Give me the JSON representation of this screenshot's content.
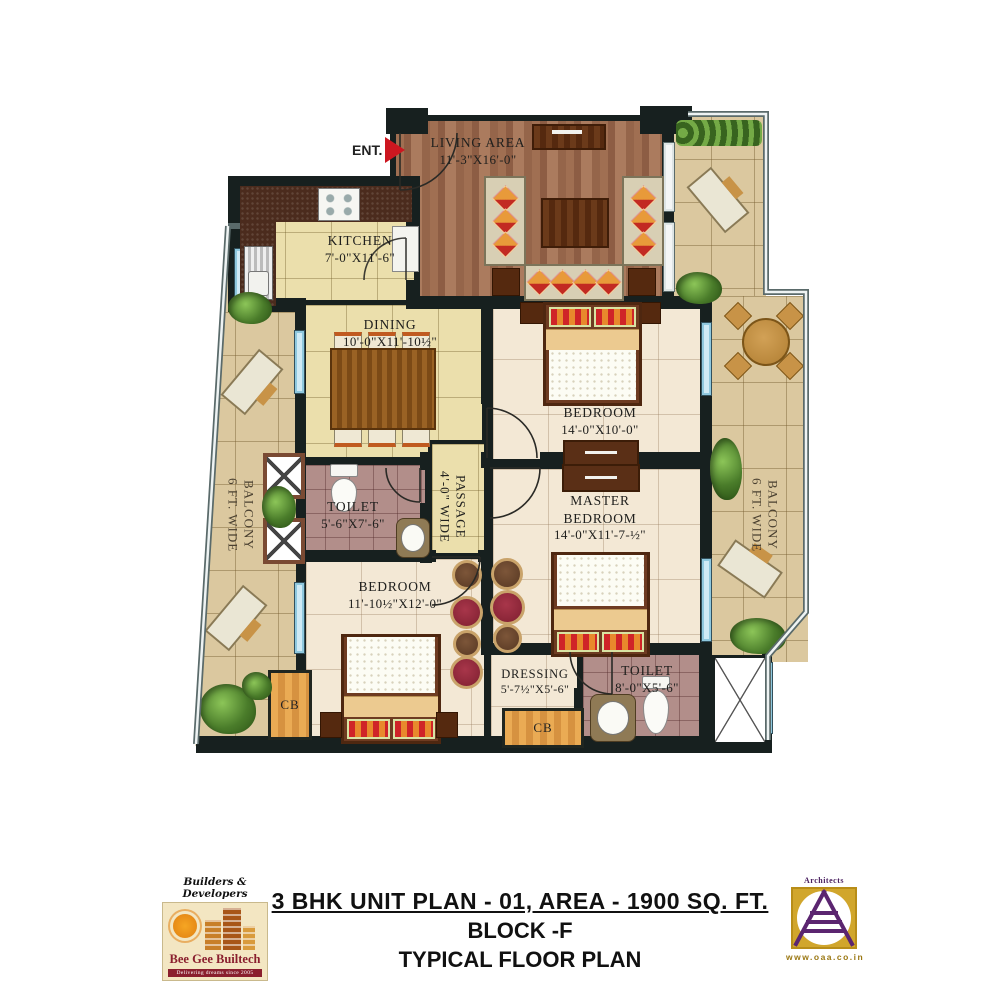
{
  "entry": {
    "label": "ENT."
  },
  "rooms": {
    "living": {
      "name": "LIVING AREA",
      "dim": "11'-3\"X16'-0\""
    },
    "kitchen": {
      "name": "KITCHEN",
      "dim": "7'-0\"X11'-6\""
    },
    "dining": {
      "name": "DINING",
      "dim": "10'-0\"X11'-10½\""
    },
    "bedroom1": {
      "name": "BEDROOM",
      "dim": "14'-0\"X10'-0\""
    },
    "master_bedroom": {
      "name": "MASTER BEDROOM",
      "dim": "14'-0\"X11'-7-½\""
    },
    "bedroom2": {
      "name": "BEDROOM",
      "dim": "11'-10½\"X12'-0\""
    },
    "toilet1": {
      "name": "TOILET",
      "dim": "5'-6\"X7'-6\""
    },
    "toilet2": {
      "name": "TOILET",
      "dim": "8'-0\"X5'-6\""
    },
    "dressing": {
      "name": "DRESSING",
      "dim": "5'-7½\"X5'-6\""
    },
    "passage": {
      "name": "4'-0\" WIDE PASSAGE"
    },
    "balcony_left": {
      "name": "6 FT. WIDE BALCONY"
    },
    "balcony_right": {
      "name": "6 FT. WIDE BALCONY"
    },
    "cabinet1": {
      "label": "CB"
    },
    "cabinet2": {
      "label": "CB"
    }
  },
  "title_block": {
    "line1": "3 BHK  UNIT PLAN - 01, AREA - 1900 SQ. FT.",
    "line2": "BLOCK -F",
    "line3": "TYPICAL FLOOR PLAN"
  },
  "builder_logo": {
    "tagline_top": "Builders & Developers",
    "name": "Bee Gee Builtech",
    "tagline_bottom": "Delivering dreams since 2005"
  },
  "architect_logo": {
    "label_top": "Architects",
    "website": "www.oaa.co.in"
  },
  "colors": {
    "wall": "#17201f",
    "entry_arrow_red": "#cc1620",
    "wood_floor": "#9a6b50",
    "tile_yellow": "#ebdfac",
    "tile_cream": "#f3e8d5",
    "tile_mauve": "#b28e8a",
    "tile_tan": "#dbc89f",
    "builder_maroon": "#8a1f2e",
    "architect_gold": "#d1a62c",
    "architect_purple": "#4a2060"
  }
}
